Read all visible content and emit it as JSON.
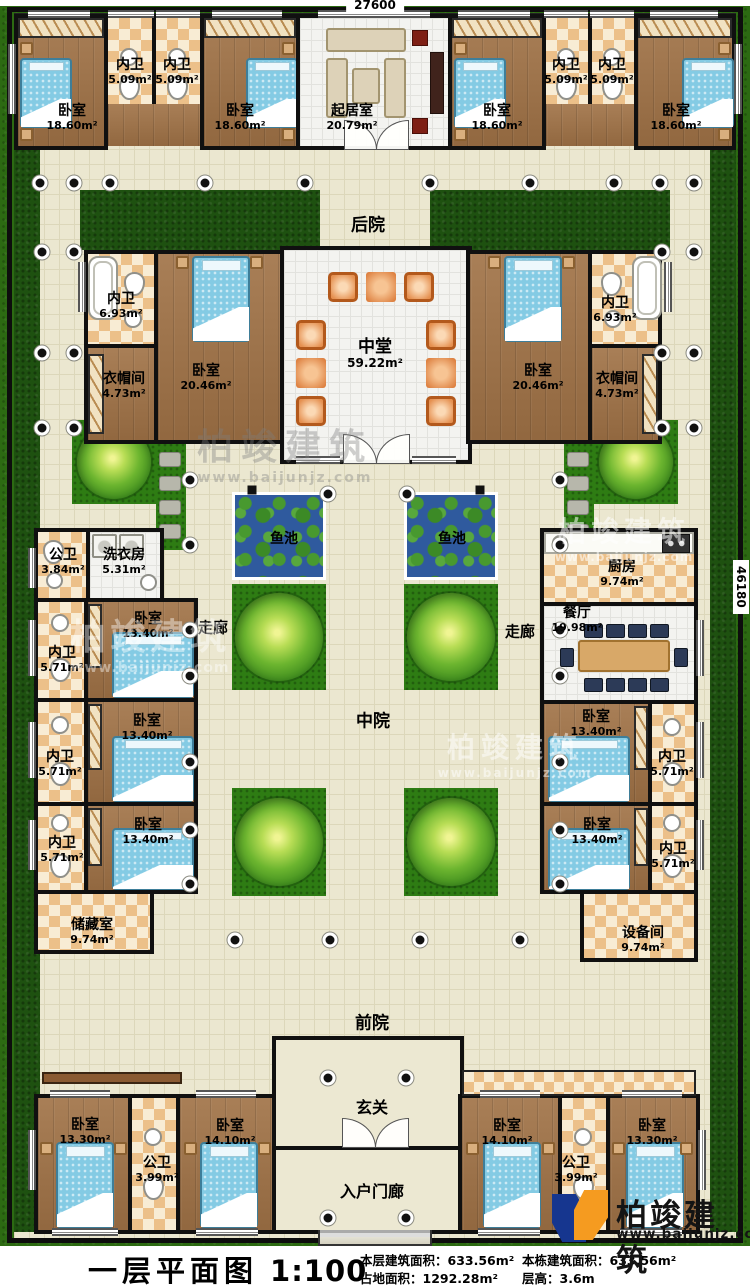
{
  "dimensions": {
    "top": "27600",
    "right": "46180"
  },
  "areas": {
    "backyard": "后院",
    "middle_court": "中院",
    "front_yard": "前院",
    "corridor": "走廊",
    "fish_pond": "鱼池",
    "entry_hall": "玄关",
    "entry_porch": "入户门廊"
  },
  "rooms": {
    "tb1": {
      "name": "卧室",
      "area": "18.60m²"
    },
    "tbath1": {
      "name": "内卫",
      "area": "5.09m²"
    },
    "tbath2": {
      "name": "内卫",
      "area": "5.09m²"
    },
    "tb2": {
      "name": "卧室",
      "area": "18.60m²"
    },
    "living": {
      "name": "起居室",
      "area": "20.79m²"
    },
    "tb3": {
      "name": "卧室",
      "area": "18.60m²"
    },
    "tbath3": {
      "name": "内卫",
      "area": "5.09m²"
    },
    "tbath4": {
      "name": "内卫",
      "area": "5.09m²"
    },
    "tb4": {
      "name": "卧室",
      "area": "18.60m²"
    },
    "mbathL": {
      "name": "内卫",
      "area": "6.93m²"
    },
    "mclosL": {
      "name": "衣帽间",
      "area": "4.73m²"
    },
    "mbrL": {
      "name": "卧室",
      "area": "20.46m²"
    },
    "hall": {
      "name": "中堂",
      "area": "59.22m²"
    },
    "mbrR": {
      "name": "卧室",
      "area": "20.46m²"
    },
    "mbathR": {
      "name": "内卫",
      "area": "6.93m²"
    },
    "mclosR": {
      "name": "衣帽间",
      "area": "4.73m²"
    },
    "pubwcL": {
      "name": "公卫",
      "area": "3.84m²"
    },
    "laundry": {
      "name": "洗衣房",
      "area": "5.31m²"
    },
    "wbathL1": {
      "name": "内卫",
      "area": "5.71m²"
    },
    "wbrL1": {
      "name": "卧室",
      "area": "13.40m²"
    },
    "wbathL2": {
      "name": "内卫",
      "area": "5.71m²"
    },
    "wbrL2": {
      "name": "卧室",
      "area": "13.40m²"
    },
    "wbathL3": {
      "name": "内卫",
      "area": "5.71m²"
    },
    "wbrL3": {
      "name": "卧室",
      "area": "13.40m²"
    },
    "storage": {
      "name": "储藏室",
      "area": "9.74m²"
    },
    "kitchen": {
      "name": "厨房",
      "area": "9.74m²"
    },
    "dining": {
      "name": "餐厅",
      "area": "19.98m²"
    },
    "wbrR1": {
      "name": "卧室",
      "area": "13.40m²"
    },
    "wbathR1": {
      "name": "内卫",
      "area": "5.71m²"
    },
    "wbrR2": {
      "name": "卧室",
      "area": "13.40m²"
    },
    "wbathR2": {
      "name": "内卫",
      "area": "5.71m²"
    },
    "equip": {
      "name": "设备间",
      "area": "9.74m²"
    },
    "fbrL1": {
      "name": "卧室",
      "area": "13.30m²"
    },
    "fwcL": {
      "name": "公卫",
      "area": "3.99m²"
    },
    "fbrL2": {
      "name": "卧室",
      "area": "14.10m²"
    },
    "fbrR1": {
      "name": "卧室",
      "area": "14.10m²"
    },
    "fwcR": {
      "name": "公卫",
      "area": "3.99m²"
    },
    "fbrR2": {
      "name": "卧室",
      "area": "13.30m²"
    }
  },
  "title_block": {
    "plan_title": "一层平面图",
    "scale": "1:100",
    "s1_label": "本层建筑面积：",
    "s1_value": "633.56m²",
    "s2_label": "占地面积：",
    "s2_value": "1292.28m²",
    "s3_label": "本栋建筑面积：",
    "s3_value": "633.56m²",
    "s4_label": "层高：",
    "s4_value": "3.6m"
  },
  "brand": {
    "name": "柏竣建筑",
    "site": "www.baijunjz.com"
  },
  "watermark": {
    "name": "柏竣建筑",
    "site": "www.baijunjz.com"
  }
}
